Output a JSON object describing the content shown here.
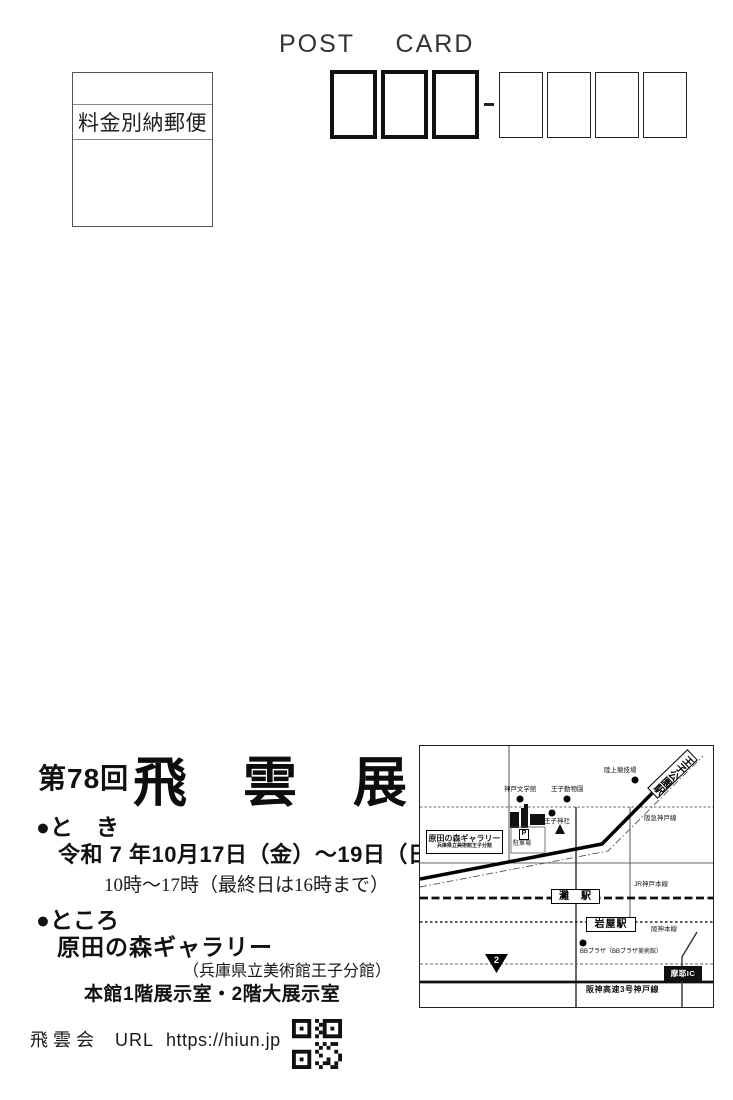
{
  "header": {
    "title": "POST CARD"
  },
  "stamp": {
    "label": "料金別納郵便"
  },
  "exhibition": {
    "round": "第78回",
    "title": "飛雲展",
    "when_label": "●と　き",
    "date_line": "令和 7 年10月17日（金）～19日（日）",
    "hours_line": "10時～17時（最終日は16時まで）",
    "where_label": "●ところ",
    "venue": "原田の森ギャラリー",
    "venue_note": "（兵庫県立美術館王子分館）",
    "rooms_line": "本館1階展示室・2階大展示室"
  },
  "footer": {
    "org": "飛雲会",
    "url_label": "URL",
    "url": "https://hiun.jp"
  },
  "map": {
    "station_oji_koen": "王子公園駅",
    "station_nada": "灘　駅",
    "station_iwaya": "岩屋駅",
    "poi_stadium": "陸上競技場",
    "poi_literature_museum": "神戸文学館",
    "poi_zoo": "王子動物園",
    "poi_shrine": "王子神社",
    "poi_bb_plaza": "BBプラザ（BBプラザ美術館）",
    "gallery_name": "原田の森ギャラリー",
    "gallery_subtitle": "兵庫県立美術館王子分館",
    "parking_symbol": "P",
    "parking_label": "駐車場",
    "line_hankyu": "阪急神戸線",
    "line_jr": "JR神戸本線",
    "line_hanshin": "阪神本線",
    "line_expressway": "阪神高速3号神戸線",
    "route_number": "2",
    "ic_label": "摩耶IC"
  },
  "colors": {
    "ink": "#1c1c1c",
    "paper": "#ffffff"
  }
}
